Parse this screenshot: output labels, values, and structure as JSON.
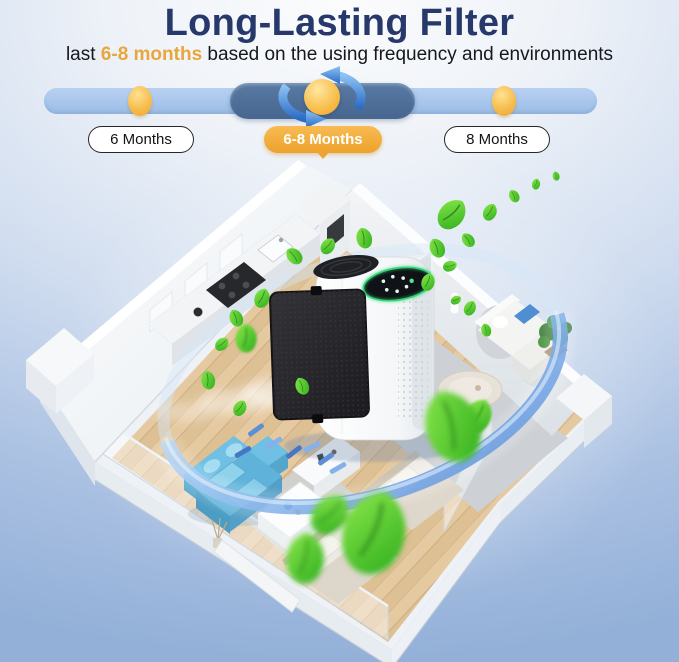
{
  "page": {
    "width": 679,
    "height": 662
  },
  "header": {
    "title": "Long-Lasting Filter",
    "subtitle": {
      "prefix": "last ",
      "highlight": "6-8 months",
      "suffix": " based on the using frequency and environments"
    }
  },
  "timeline": {
    "items": [
      {
        "label": "6 Months",
        "state": "normal"
      },
      {
        "label": "6-8 Months",
        "state": "active"
      },
      {
        "label": "8 Months",
        "state": "normal"
      }
    ],
    "active_marker_icon": "rotation-arrows-icon",
    "dot_icon": "gold-dot-icon"
  },
  "illustration": {
    "scene": "isometric-house-floor-plan",
    "elements": [
      "air-purifier",
      "pulled-out-filter-panel",
      "purifier-display",
      "airflow-ring",
      "filter-fragments",
      "green-leaves",
      "kitchen",
      "blue-sofa",
      "coffee-table",
      "white-sofa",
      "potted-plant",
      "beds",
      "balcony-glass-railing"
    ]
  },
  "colors": {
    "title_navy": "#27396b",
    "highlight_gold": "#e9a63c",
    "track_blue": "#a9c7ed",
    "active_segment_blue": "#4b6d9c",
    "dot_gold": "#f5b741",
    "active_pill_gold": "#f0a838",
    "background_blue": "#9cb8dd",
    "leaf_green": "#4ec82d",
    "sofa_blue": "#5fb3da",
    "filter_black": "#26262a",
    "display_green": "#3ade7c"
  }
}
